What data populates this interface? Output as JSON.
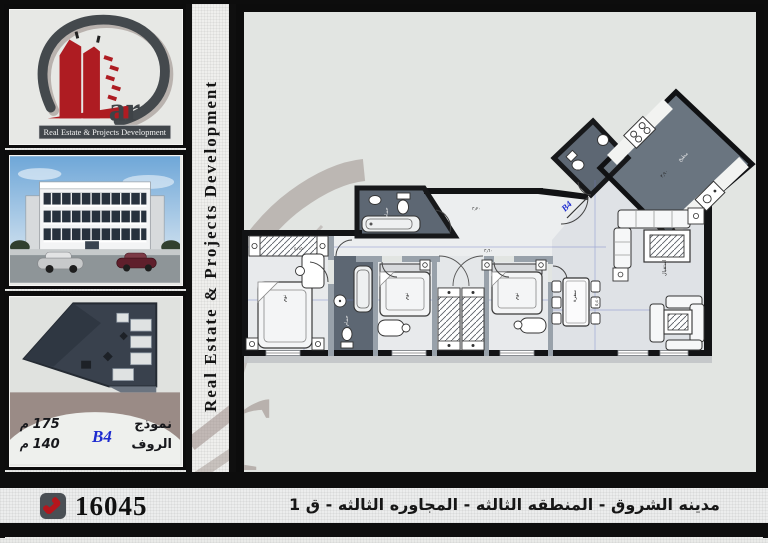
{
  "brand": {
    "suffix": "ar",
    "banner": "Real Estate & Projects Development",
    "side_text": "Real Estate & Projects Development",
    "watermark": "ar"
  },
  "model": {
    "label": "نموذج",
    "code": "B4",
    "area": "175 م",
    "roof_label": "الروف",
    "roof_area": "140 م"
  },
  "contact": {
    "phone": "16045"
  },
  "footer": {
    "address": "مدينه الشروق - المنطقه الثالثه - المجاوره الثالثه - ق 1"
  },
  "floor_plan": {
    "entry_label": "B4",
    "rooms": [
      {
        "label": "نوم"
      },
      {
        "label": "حمام"
      },
      {
        "label": "نوم"
      },
      {
        "label": "نوم"
      },
      {
        "label": "سفرة"
      },
      {
        "label": "استقبال"
      },
      {
        "label": "مطبخ"
      },
      {
        "label": "حمام"
      }
    ],
    "dims": [
      "٤٫١٥",
      "٣٫٦٠",
      "٥٫٤٠",
      "٣٫٢٠",
      "٣٫٩٠"
    ]
  },
  "colors": {
    "accent_red": "#ae1c22",
    "frame_black": "#0d0d0d",
    "taupe": "#9a8b86",
    "plan_bg": "#e2e5e2",
    "bath_dark": "#5d6773",
    "label_blue": "#1d2bd0"
  }
}
